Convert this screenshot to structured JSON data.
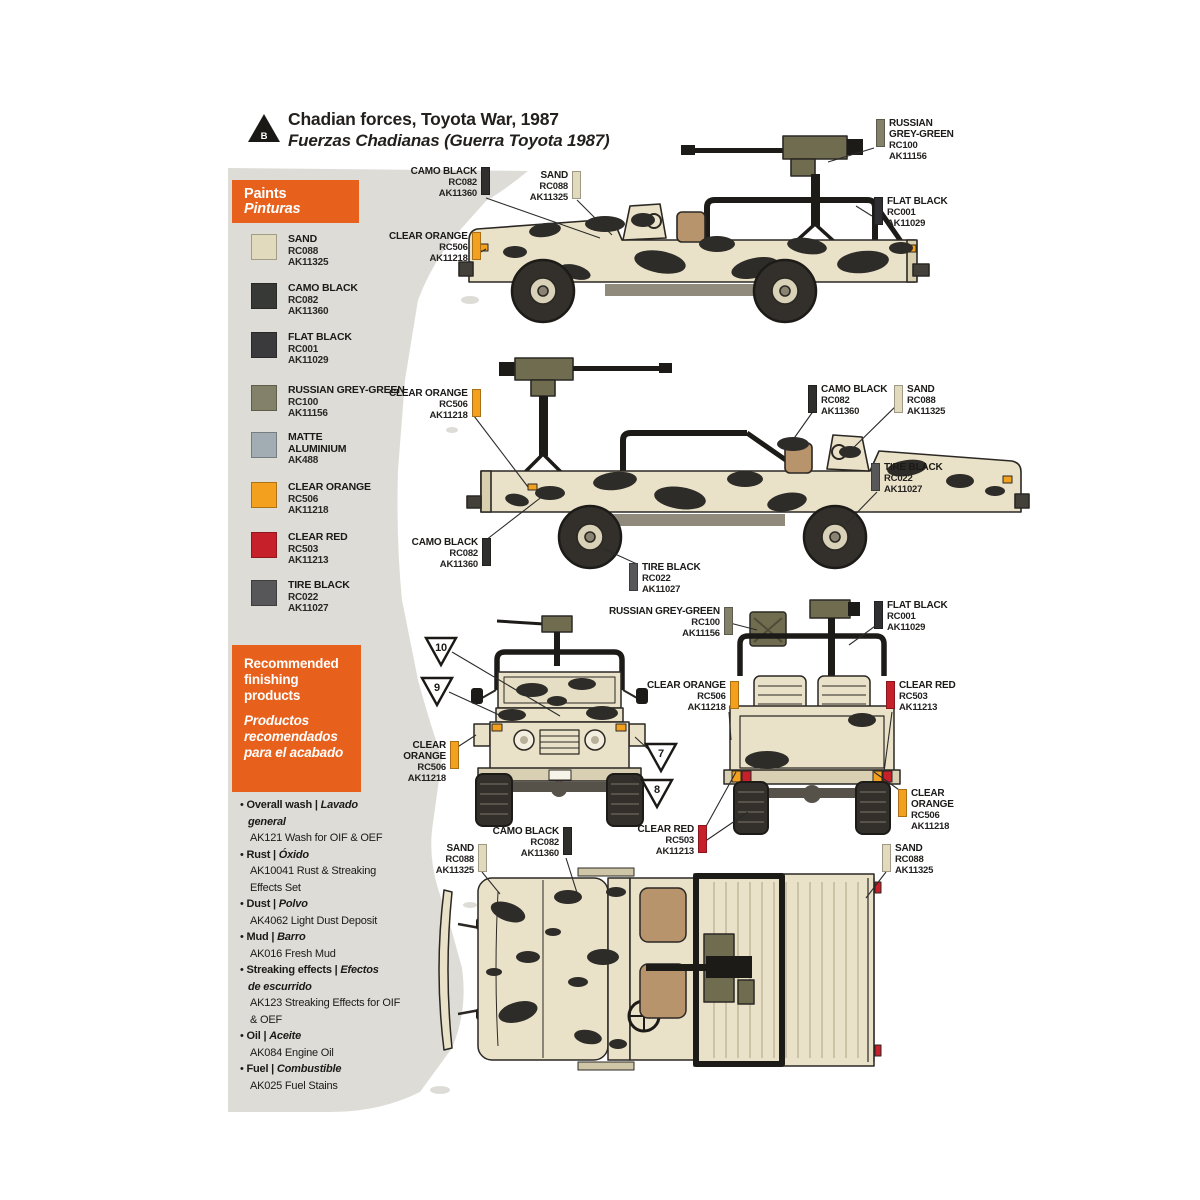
{
  "header": {
    "marker": "B",
    "title": "Chadian forces, Toyota War, 1987",
    "subtitle": "Fuerzas Chadianas (Guerra Toyota 1987)"
  },
  "colors": {
    "accent_orange": "#e8611c",
    "paper_grey": "#dedcd6",
    "sand_body": "#eae2c8",
    "camo_blob": "#2e2c28"
  },
  "paints": {
    "title_en": "Paints",
    "title_es": "Pinturas",
    "swatches": [
      {
        "name_lines": [
          "SAND"
        ],
        "code": "RC088",
        "ak": "AK11325",
        "color": "#e2dabd",
        "y": 234
      },
      {
        "name_lines": [
          "CAMO BLACK"
        ],
        "code": "RC082",
        "ak": "AK11360",
        "color": "#373936",
        "y": 283
      },
      {
        "name_lines": [
          "FLAT BLACK"
        ],
        "code": "RC001",
        "ak": "AK11029",
        "color": "#3a3a3c",
        "y": 332
      },
      {
        "name_lines": [
          "RUSSIAN GREY-GREEN"
        ],
        "code": "RC100",
        "ak": "AK11156",
        "color": "#84816a",
        "y": 385
      },
      {
        "name_lines": [
          "MATTE",
          "ALUMINIUM"
        ],
        "code": "",
        "ak": "AK488",
        "color": "#a2adb3",
        "y": 432
      },
      {
        "name_lines": [
          "CLEAR ORANGE"
        ],
        "code": "RC506",
        "ak": "AK11218",
        "color": "#f2a01e",
        "y": 482
      },
      {
        "name_lines": [
          "CLEAR RED"
        ],
        "code": "RC503",
        "ak": "AK11213",
        "color": "#c6202a",
        "y": 532
      },
      {
        "name_lines": [
          "TIRE BLACK"
        ],
        "code": "RC022",
        "ak": "AK11027",
        "color": "#57575a",
        "y": 580
      }
    ]
  },
  "finishing": {
    "title_en": "Recommended finishing products",
    "title_es": "Productos recomendados para el acabado",
    "items": [
      {
        "en": "Overall wash |",
        "es": "Lavado general",
        "products": [
          "AK121 Wash for OIF & OEF"
        ]
      },
      {
        "en": "Rust |",
        "es": "Óxido",
        "products": [
          "AK10041 Rust & Streaking Effects Set"
        ]
      },
      {
        "en": "Dust |",
        "es": "Polvo",
        "products": [
          "AK4062 Light Dust Deposit"
        ]
      },
      {
        "en": "Mud |",
        "es": "Barro",
        "products": [
          "AK016 Fresh Mud"
        ]
      },
      {
        "en": "Streaking effects |",
        "es": "Efectos de escurrido",
        "products": [
          "AK123 Streaking Effects for OIF & OEF"
        ]
      },
      {
        "en": "Oil |",
        "es": "Aceite",
        "products": [
          "AK084 Engine Oil"
        ]
      },
      {
        "en": "Fuel |",
        "es": "Combustible",
        "products": [
          "AK025 Fuel Stains"
        ]
      }
    ]
  },
  "callouts": [
    {
      "id": "v1-camo-black",
      "name": [
        "CAMO BLACK"
      ],
      "codes": [
        "RC082",
        "AK11360"
      ],
      "color": "#2f2f2d",
      "side": "right",
      "x": 406,
      "y": 166,
      "w": 70
    },
    {
      "id": "v1-sand",
      "name": [
        "SAND"
      ],
      "codes": [
        "RC088",
        "AK11325"
      ],
      "color": "#e2dabd",
      "side": "right",
      "x": 521,
      "y": 170,
      "w": 46
    },
    {
      "id": "v1-clear-orange",
      "name": [
        "CLEAR ORANGE"
      ],
      "codes": [
        "RC506",
        "AK11218"
      ],
      "color": "#f2a01e",
      "side": "right",
      "x": 389,
      "y": 231,
      "w": 76
    },
    {
      "id": "v1-russian-grey-green",
      "name": [
        "RUSSIAN",
        "GREY-GREEN"
      ],
      "codes": [
        "RC100",
        "AK11156"
      ],
      "color": "#84816a",
      "side": "left",
      "x": 876,
      "y": 118,
      "w": 0
    },
    {
      "id": "v1-flat-black",
      "name": [
        "FLAT BLACK"
      ],
      "codes": [
        "RC001",
        "AK11029"
      ],
      "color": "#2f2f31",
      "side": "left",
      "x": 874,
      "y": 196,
      "w": 0
    },
    {
      "id": "v2-clear-orange",
      "name": [
        "CLEAR ORANGE"
      ],
      "codes": [
        "RC506",
        "AK11218"
      ],
      "color": "#f2a01e",
      "side": "right",
      "x": 389,
      "y": 388,
      "w": 76
    },
    {
      "id": "v2-camo-black-left",
      "name": [
        "CAMO BLACK"
      ],
      "codes": [
        "RC082",
        "AK11360"
      ],
      "color": "#2f2f2d",
      "side": "right",
      "x": 407,
      "y": 537,
      "w": 70
    },
    {
      "id": "v2-camo-black-right",
      "name": [
        "CAMO BLACK"
      ],
      "codes": [
        "RC082",
        "AK11360"
      ],
      "color": "#2f2f2d",
      "side": "left",
      "x": 808,
      "y": 384,
      "w": 0
    },
    {
      "id": "v2-sand",
      "name": [
        "SAND"
      ],
      "codes": [
        "RC088",
        "AK11325"
      ],
      "color": "#e2dabd",
      "side": "left",
      "x": 894,
      "y": 384,
      "w": 0
    },
    {
      "id": "v2-tire-black-right",
      "name": [
        "TIRE BLACK"
      ],
      "codes": [
        "RC022",
        "AK11027"
      ],
      "color": "#57575a",
      "side": "left",
      "x": 871,
      "y": 462,
      "w": 0
    },
    {
      "id": "v2-tire-black-bottom",
      "name": [
        "TIRE BLACK"
      ],
      "codes": [
        "RC022",
        "AK11027"
      ],
      "color": "#57575a",
      "side": "left",
      "x": 629,
      "y": 562,
      "w": 0
    },
    {
      "id": "v4-russian-grey-green",
      "name": [
        "RUSSIAN GREY-GREEN"
      ],
      "codes": [
        "RC100",
        "AK11156"
      ],
      "color": "#84816a",
      "side": "right",
      "x": 609,
      "y": 606,
      "w": 108
    },
    {
      "id": "v3-clear-orange",
      "name": [
        "CLEAR",
        "ORANGE"
      ],
      "codes": [
        "RC506",
        "AK11218"
      ],
      "color": "#f2a01e",
      "side": "right",
      "x": 395,
      "y": 740,
      "w": 50
    },
    {
      "id": "v4-flat-black",
      "name": [
        "FLAT BLACK"
      ],
      "codes": [
        "RC001",
        "AK11029"
      ],
      "color": "#2f2f31",
      "side": "left",
      "x": 874,
      "y": 600,
      "w": 0
    },
    {
      "id": "v4-clear-orange",
      "name": [
        "CLEAR ORANGE"
      ],
      "codes": [
        "RC506",
        "AK11218"
      ],
      "color": "#f2a01e",
      "side": "right",
      "x": 647,
      "y": 680,
      "w": 76
    },
    {
      "id": "v4-clear-red",
      "name": [
        "CLEAR RED"
      ],
      "codes": [
        "RC503",
        "AK11213"
      ],
      "color": "#c6202a",
      "side": "left",
      "x": 886,
      "y": 680,
      "w": 0
    },
    {
      "id": "v4-clear-red-bottom",
      "name": [
        "CLEAR RED"
      ],
      "codes": [
        "RC503",
        "AK11213"
      ],
      "color": "#c6202a",
      "side": "right",
      "x": 633,
      "y": 824,
      "w": 60
    },
    {
      "id": "v4-clear-orange-bottom",
      "name": [
        "CLEAR",
        "ORANGE"
      ],
      "codes": [
        "RC506",
        "AK11218"
      ],
      "color": "#f2a01e",
      "side": "left",
      "x": 898,
      "y": 788,
      "w": 0
    },
    {
      "id": "v5-sand-left",
      "name": [
        "SAND"
      ],
      "codes": [
        "RC088",
        "AK11325"
      ],
      "color": "#e2dabd",
      "side": "right",
      "x": 427,
      "y": 843,
      "w": 46
    },
    {
      "id": "v5-camo-black",
      "name": [
        "CAMO BLACK"
      ],
      "codes": [
        "RC082",
        "AK11360"
      ],
      "color": "#2f2f2d",
      "side": "right",
      "x": 488,
      "y": 826,
      "w": 70
    },
    {
      "id": "v5-sand-right",
      "name": [
        "SAND"
      ],
      "codes": [
        "RC088",
        "AK11325"
      ],
      "color": "#e2dabd",
      "side": "left",
      "x": 882,
      "y": 843,
      "w": 0
    }
  ],
  "triangles": [
    {
      "n": "10",
      "x": 424,
      "y": 636
    },
    {
      "n": "9",
      "x": 420,
      "y": 676
    },
    {
      "n": "7",
      "x": 644,
      "y": 742
    },
    {
      "n": "8",
      "x": 640,
      "y": 778
    }
  ]
}
